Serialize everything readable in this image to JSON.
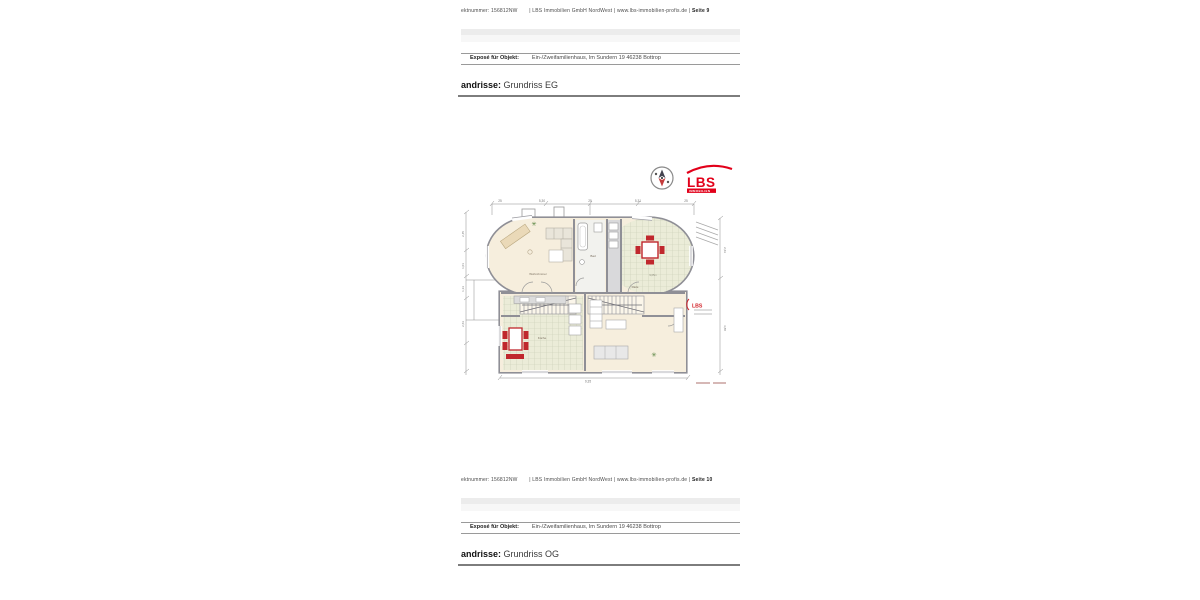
{
  "colors": {
    "lbs_red": "#e2001a",
    "furniture_red": "#c0272d",
    "wall_gray": "#8f8f96",
    "floor_cream": "#f6eedd",
    "tile_green": "#ebecd8",
    "divider_bar": "#ececec",
    "rule_gray": "#9a9a9a"
  },
  "pages": [
    {
      "meta_prefix": "ektnummer: 156812NW",
      "meta_middle": "| LBS Immobilien GmbH NordWest | www.lbs-immobilien-profis.de |",
      "meta_page": "Seite 9",
      "expose_label": "Exposé für Objekt:",
      "expose_value": "Ein-/Zweifamilienhaus, Im Sundern 19 46238 Bottrop",
      "heading_label": "andrisse:",
      "heading_value": "Grundriss EG"
    },
    {
      "meta_prefix": "ektnummer: 156812NW",
      "meta_middle": "| LBS Immobilien GmbH NordWest | www.lbs-immobilien-profis.de |",
      "meta_page": "Seite 10",
      "expose_label": "Exposé für Objekt:",
      "expose_value": "Ein-/Zweifamilienhaus, Im Sundern 19 46238 Bottrop",
      "heading_label": "andrisse:",
      "heading_value": "Grundriss OG"
    }
  ],
  "floorplan": {
    "logo": {
      "name": "LBS",
      "subtitle": "IMMOBILIEN"
    },
    "stamp": "LBS",
    "rooms": {
      "living": "Wohnzimmer",
      "bath": "Bad",
      "hall": "Diele",
      "kitchen": "Küche",
      "dining_area": "9,65m"
    },
    "dims": {
      "top": [
        "25",
        "5,30",
        "25",
        "5,31",
        "25"
      ],
      "bottom": "9,35",
      "left": [
        "2,45",
        "1,01",
        "1,13",
        "2,63"
      ],
      "right": [
        "2,63",
        "3,88"
      ]
    }
  }
}
